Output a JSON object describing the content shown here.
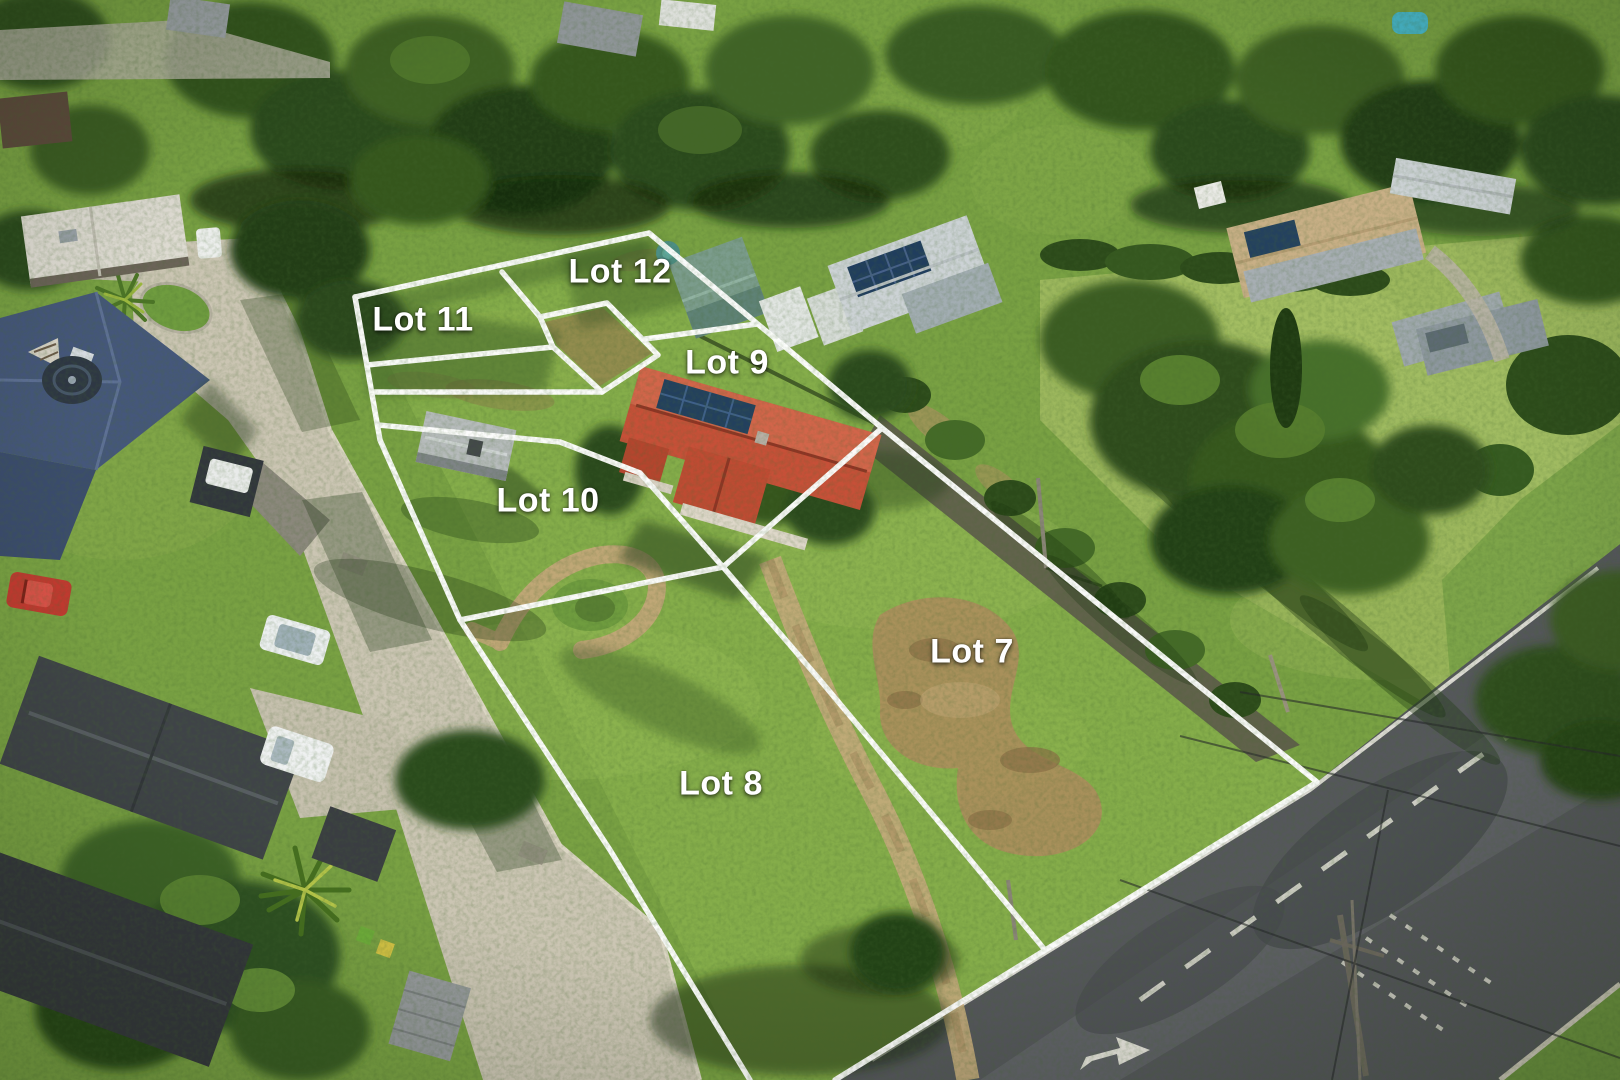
{
  "scene": {
    "type": "aerial-photograph",
    "description": "Drone aerial view of a residential land subdivision with six lots outlined in white"
  },
  "overlay": {
    "line_color": "#ffffff",
    "label_color": "#ffffff",
    "lots": [
      {
        "id": "lot-11",
        "label": "Lot 11"
      },
      {
        "id": "lot-12",
        "label": "Lot 12"
      },
      {
        "id": "lot-9",
        "label": "Lot 9"
      },
      {
        "id": "lot-10",
        "label": "Lot 10"
      },
      {
        "id": "lot-7",
        "label": "Lot 7"
      },
      {
        "id": "lot-8",
        "label": "Lot 8"
      }
    ]
  },
  "road_markings": {
    "turn_arrow_icon": "right-turn-arrow"
  }
}
